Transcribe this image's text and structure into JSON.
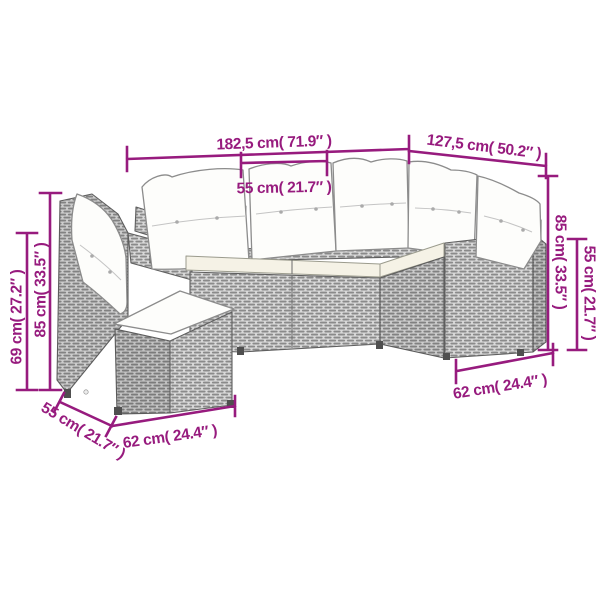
{
  "figure": {
    "kind": "product-dimension-diagram",
    "units_note": "cm"
  },
  "colors": {
    "dimension": "#971b7e",
    "background": "#ffffff",
    "wicker_base": "#d9d9d9",
    "wicker_weave": "#8a8a8a",
    "outline": "#5f5f5f",
    "pillow": "#fdfdfb",
    "seat_cushion": "#f5f2e6"
  },
  "dimensions": {
    "total_width": "182,5 cm( 71.9″ )",
    "seat_width": "55 cm( 21.7″ )",
    "side_width": "127,5 cm( 50.2″ )",
    "right_height_total": "85 cm( 33.5″ )",
    "right_height_back": "55 cm( 21.7″ )",
    "right_depth": "62 cm( 24.4″ )",
    "left_height_back": "85 cm( 33.5″ )",
    "left_height_arm": "69 cm( 27.2″ )",
    "left_side_depth": "55 cm( 21.7″ )",
    "left_depth": "62 cm( 24.4″ )"
  }
}
